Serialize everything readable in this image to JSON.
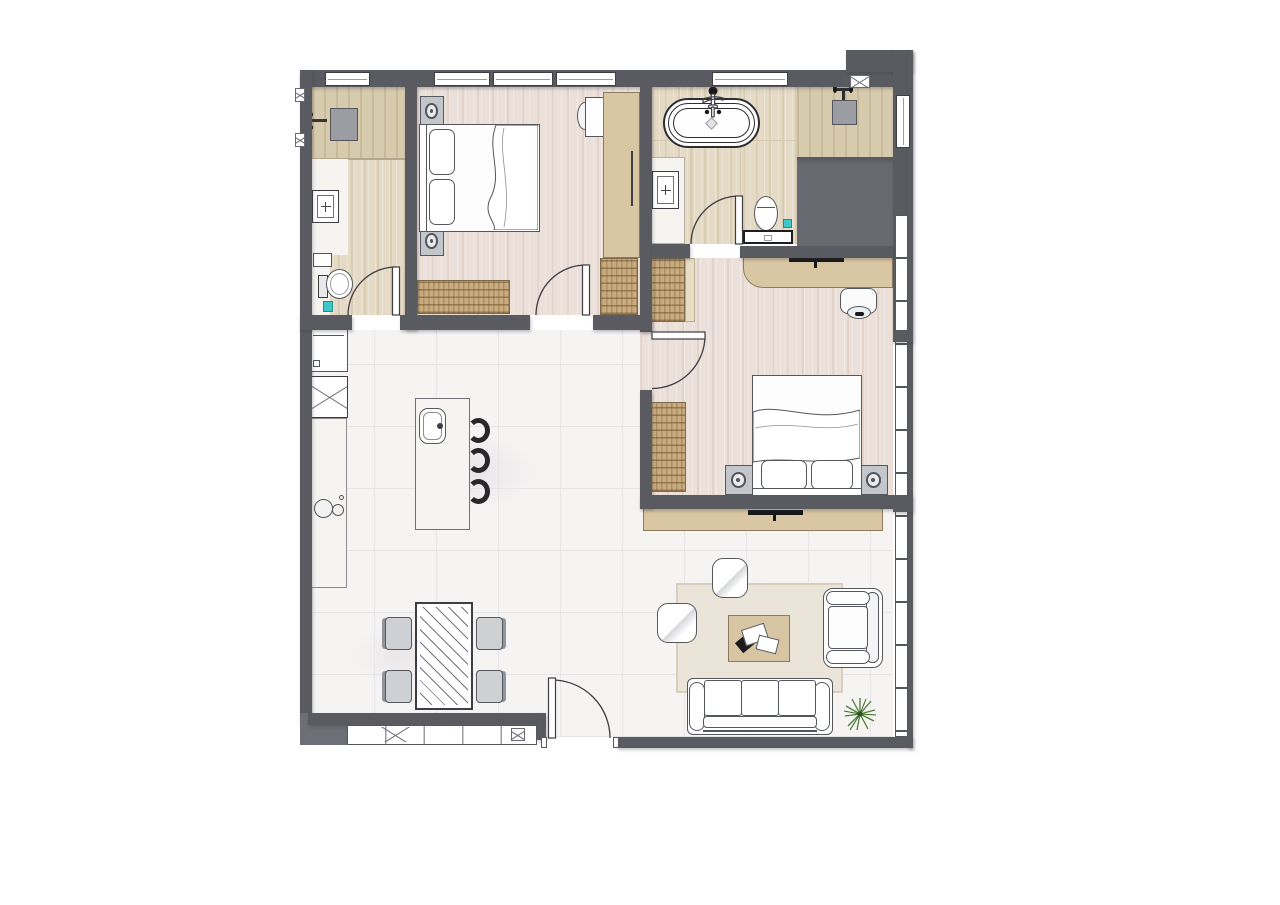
{
  "title": "apartment-floor-plan",
  "colors": {
    "wall": "#5a5a61",
    "wall_light": "#6e6e76",
    "void": "#696971",
    "outline": "#3d3d43",
    "window_line": "#9b9ba1",
    "wood_bedroom": "#ece1da",
    "wood_bath": "#e4dac5",
    "wood_bath_dark": "#d7cbae",
    "marble": "#f5f4f3",
    "marble_line": "#e6e5e7",
    "vanity": "#f6f4f1",
    "tan": "#d9c6a3",
    "tan_dark": "#8a7c61",
    "hatch": "#c8ab7f",
    "rug": "#eae5d8",
    "rug_border": "#d8d0bd",
    "gfb": "#54575b",
    "teal": "#41c6c8",
    "plant_green": "#4e7d35",
    "shower_gray": "#9c9ca3",
    "black": "#17171a"
  },
  "legend": {
    "rooms": [
      "bathroom-2",
      "bedroom-1",
      "master-bathroom",
      "shower",
      "shaft-void",
      "master-bedroom",
      "kitchen",
      "living-dining-area",
      "balcony"
    ],
    "fixtures": [
      "shower-head",
      "vanity-sink",
      "toilet",
      "bathtub",
      "tub-faucet",
      "double-bed",
      "speaker-nightstand",
      "wardrobe",
      "dresser",
      "desk",
      "desk-chair",
      "fridge",
      "oven",
      "cooktop",
      "kitchen-island",
      "island-sink",
      "bar-stool",
      "dining-table",
      "dining-chair",
      "tv-console",
      "tv",
      "sofa",
      "armchair",
      "coffee-table",
      "pouf",
      "rug",
      "plant",
      "door",
      "window",
      "vent"
    ]
  }
}
